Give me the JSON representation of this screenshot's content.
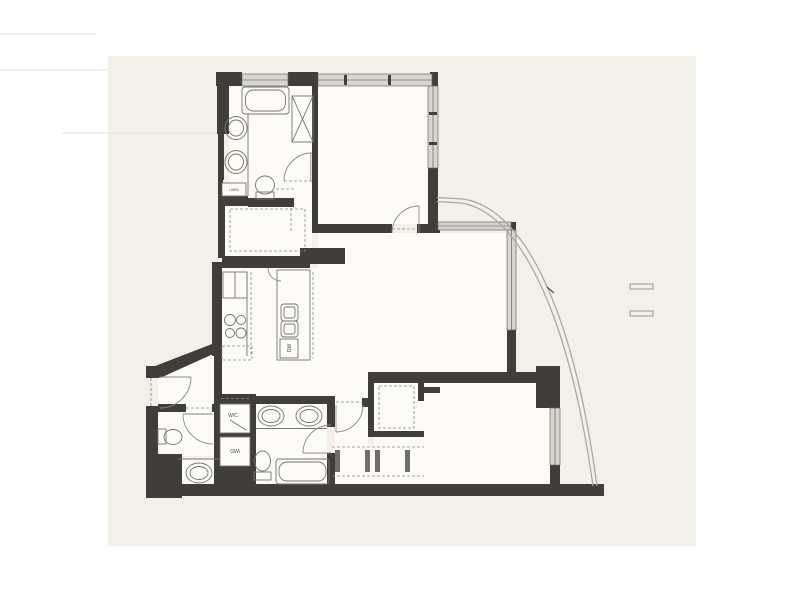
{
  "labels": {
    "walk_in_closet_box": "W/C",
    "washer_dryer_box": "W/D",
    "dishwasher": "DW",
    "linen": "LINEN"
  },
  "colors": {
    "page_background": "#ffffff",
    "paper": "#f2f0e9",
    "room_fill": "#fcfbf7",
    "wall": "#403e3a",
    "window_band": "#d6d5cf",
    "window_edge": "#6a6964",
    "fixture_line": "#75746e",
    "door_line": "#8a8984",
    "railing": "#a9a8a2",
    "label_text": "#4a4945"
  },
  "fixtures": [
    "bathtub-master",
    "shower-stall",
    "vanity-sink",
    "toilet",
    "linen-cabinet",
    "walk-in-closet",
    "refrigerator",
    "cooktop",
    "kitchen-island",
    "kitchen-sink",
    "dishwasher",
    "entry-door",
    "powder-toilet",
    "round-sink",
    "laundry-closet",
    "double-vanity",
    "second-bathtub",
    "closet-rods",
    "balcony-railing",
    "window-band"
  ]
}
